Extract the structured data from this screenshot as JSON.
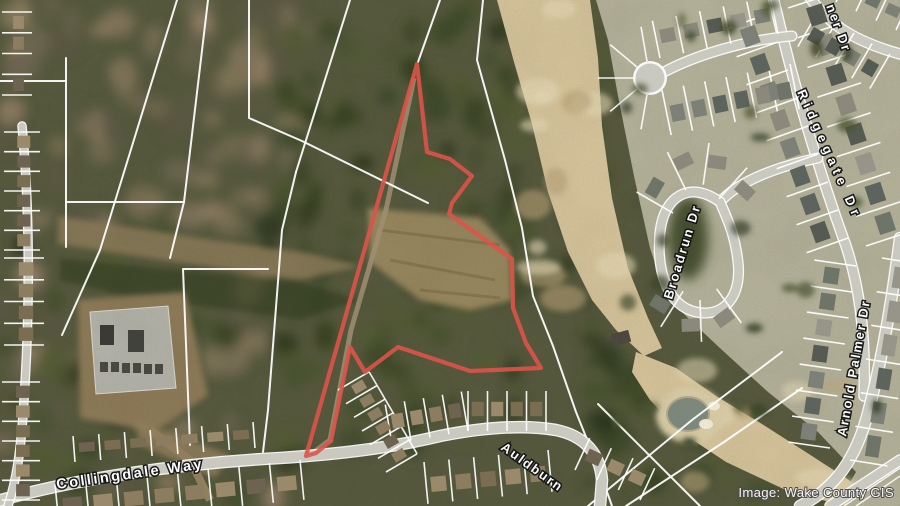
{
  "map": {
    "credit": "Image: Wake County GIS",
    "street_labels": {
      "collingdale": "Collingdale Way",
      "auldburn": "Auldburn",
      "broadrun": "Broadrun Dr",
      "ridgegate": "Ridgegate Dr",
      "arnold_palmer": "Arnold Palmer Dr",
      "partial_top_right": "ner Dr"
    },
    "parcel_outline": {
      "color": "#dd5349",
      "points": [
        [
          417,
          64
        ],
        [
          427,
          152
        ],
        [
          450,
          159
        ],
        [
          472,
          176
        ],
        [
          452,
          203
        ],
        [
          449,
          214
        ],
        [
          512,
          259
        ],
        [
          513,
          308
        ],
        [
          526,
          343
        ],
        [
          541,
          368
        ],
        [
          470,
          371
        ],
        [
          425,
          356
        ],
        [
          398,
          347
        ],
        [
          365,
          372
        ],
        [
          350,
          347
        ],
        [
          331,
          441
        ],
        [
          316,
          453
        ],
        [
          306,
          456
        ]
      ]
    },
    "palette": {
      "forest_dark": "#3f4a2e",
      "forest_bare": "#7d7257",
      "sand": "#d6c49c",
      "road": "#c9c9c0",
      "lawn": "#b5b29b",
      "dirt": "#8a7a58",
      "water": "#7f8b80",
      "parcel_line": "#ffffff"
    }
  }
}
